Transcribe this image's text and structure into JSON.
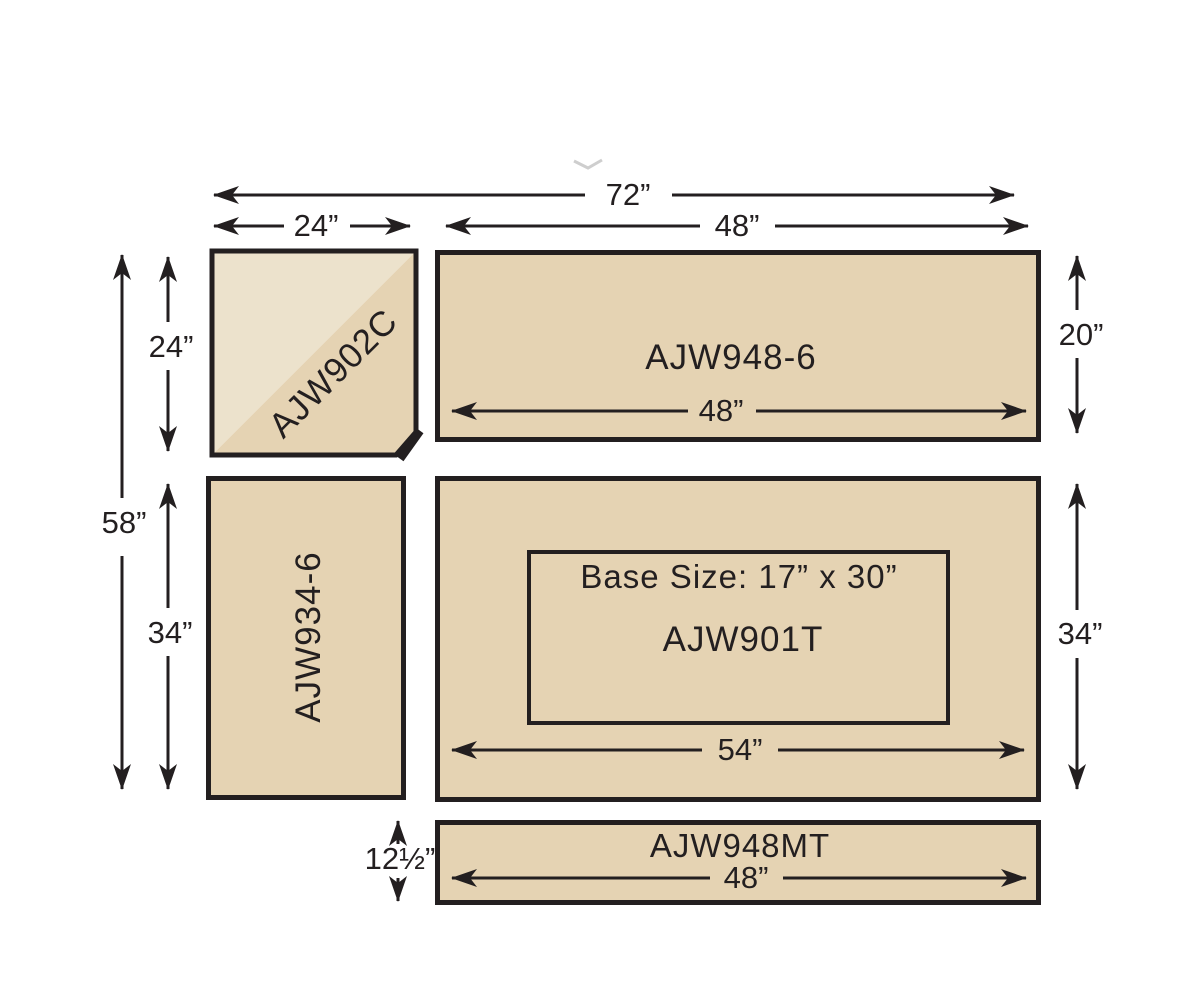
{
  "diagram": {
    "title": "countertop-layout-diagram",
    "colors": {
      "surface_tan": "#e5d3b3",
      "surface_light": "#ece2cc",
      "outline": "#231f20",
      "background": "#ffffff"
    },
    "dims": {
      "total_width": "72”",
      "corner_width": "24”",
      "right_width": "48”",
      "corner_height": "24”",
      "total_height": "58”",
      "left_section_height": "34”",
      "top_right_height": "20”",
      "main_height": "34”",
      "strip_height": "12½”"
    },
    "pieces": {
      "corner_label": "AJW902C",
      "top_right_label": "AJW948-6",
      "top_right_width": "48”",
      "left_label": "AJW934-6",
      "main_label": "AJW901T",
      "main_base_size": "Base Size: 17” x 30”",
      "main_width": "54”",
      "strip_label": "AJW948MT",
      "strip_width": "48”"
    }
  }
}
